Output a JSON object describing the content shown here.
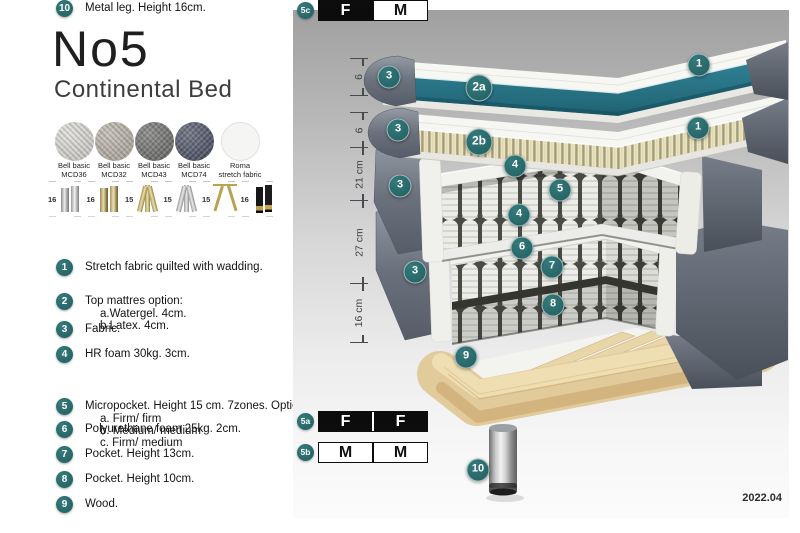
{
  "product": {
    "name": "No5",
    "type": "Continental Bed"
  },
  "fabrics": [
    {
      "line1": "Bell basic",
      "line2": "MCD36",
      "style": "mcd36"
    },
    {
      "line1": "Bell basic",
      "line2": "MCD32",
      "style": "mcd32"
    },
    {
      "line1": "Bell basic",
      "line2": "MCD43",
      "style": "mcd43"
    },
    {
      "line1": "Bell basic",
      "line2": "MCD74",
      "style": "mcd74"
    },
    {
      "line1": "Roma",
      "line2": "stretch fabric",
      "style": "roma"
    }
  ],
  "legs": [
    {
      "height": "16",
      "style": "cyl-silver"
    },
    {
      "height": "16",
      "style": "cyl-gold"
    },
    {
      "height": "15",
      "style": "twist-gold"
    },
    {
      "height": "15",
      "style": "twist-silver"
    },
    {
      "height": "15",
      "style": "hairpin-gold"
    },
    {
      "height": "16",
      "style": "black-gold"
    }
  ],
  "features": [
    {
      "n": "1",
      "text": "Stretch fabric quilted with wadding."
    },
    {
      "n": "2",
      "text": "Top mattres option:",
      "sub1": "a.Watergel. 4cm.",
      "sub2": "b.Latex. 4cm."
    },
    {
      "n": "3",
      "text": "Fabric."
    },
    {
      "n": "4",
      "text": "HR foam 30kg. 3cm."
    },
    {
      "n": "5",
      "text": "Micropocket. Height 15 cm. 7zones. Option:",
      "sub1": "a. Firm/ firm",
      "sub2": "b. Medium/ medium",
      "sub3": "c. Firm/ medium"
    },
    {
      "n": "6",
      "text": "Polyurethane foam 25kg. 2cm."
    },
    {
      "n": "7",
      "text": "Pocket. Height 13cm."
    },
    {
      "n": "8",
      "text": "Pocket. Height 10cm."
    },
    {
      "n": "9",
      "text": "Wood."
    },
    {
      "n": "10",
      "text": "Metal leg. Height 16cm."
    }
  ],
  "diagram": {
    "ruler": [
      "6",
      "6",
      "21 cm",
      "27 cm",
      "16 cm"
    ],
    "callouts": [
      {
        "n": "3",
        "x": 389,
        "y": 77
      },
      {
        "n": "2a",
        "x": 479,
        "y": 88,
        "big": "big"
      },
      {
        "n": "1",
        "x": 699,
        "y": 65
      },
      {
        "n": "3",
        "x": 398,
        "y": 130
      },
      {
        "n": "2b",
        "x": 479,
        "y": 142,
        "big": "big"
      },
      {
        "n": "1",
        "x": 698,
        "y": 128
      },
      {
        "n": "4",
        "x": 515,
        "y": 166
      },
      {
        "n": "5",
        "x": 560,
        "y": 190
      },
      {
        "n": "3",
        "x": 400,
        "y": 186
      },
      {
        "n": "4",
        "x": 519,
        "y": 215
      },
      {
        "n": "6",
        "x": 522,
        "y": 248
      },
      {
        "n": "7",
        "x": 552,
        "y": 267
      },
      {
        "n": "3",
        "x": 415,
        "y": 272
      },
      {
        "n": "8",
        "x": 553,
        "y": 305
      },
      {
        "n": "9",
        "x": 466,
        "y": 357
      },
      {
        "n": "10",
        "x": 478,
        "y": 470
      }
    ],
    "firmness": [
      {
        "label": "5a",
        "c1": "F",
        "f1": "dark",
        "c2": "F",
        "f2": "dark",
        "divider": "gap-light"
      },
      {
        "label": "5b",
        "c1": "M",
        "f1": "light",
        "c2": "M",
        "f2": "light",
        "divider": "gap-dark"
      },
      {
        "label": "5c",
        "c1": "F",
        "f1": "dark",
        "c2": "M",
        "f2": "light",
        "divider": "gap-dark"
      }
    ],
    "version": "2022.04"
  },
  "colors": {
    "accent_teal": "#2a6c6e",
    "layer_teal": "#2b7a8e",
    "fabric_gray": "#636973",
    "wood": "#e5cfa0"
  }
}
